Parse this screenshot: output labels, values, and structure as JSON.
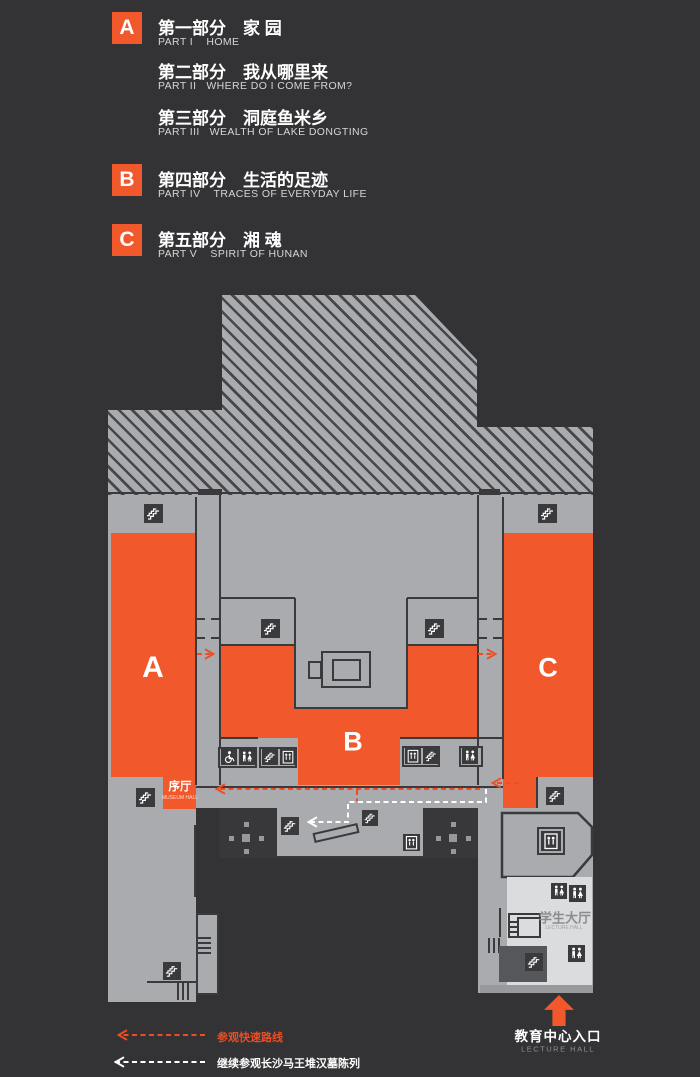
{
  "colors": {
    "orange": "#F1582B",
    "route_red": "#EE4D22",
    "background": "#333234",
    "floor_gray": "#A9ABAE",
    "wall_dark": "#3A393B",
    "light_hall": "#DBDCDD",
    "white": "#FFFFFF"
  },
  "legend": {
    "items": [
      {
        "letter": "A",
        "title": "第一部分　家 园",
        "subtitle": "PART I    HOME"
      },
      {
        "letter": "",
        "title": "第二部分　我从哪里来",
        "subtitle": "PART II   WHERE DO I COME FROM?"
      },
      {
        "letter": "",
        "title": "第三部分　洞庭鱼米乡",
        "subtitle": "PART III   WEALTH OF LAKE DONGTING"
      },
      {
        "letter": "B",
        "title": "第四部分　生活的足迹",
        "subtitle": "PART IV    TRACES OF EVERYDAY LIFE"
      },
      {
        "letter": "C",
        "title": "第五部分　湘 魂",
        "subtitle": "PART V    SPIRIT OF HUNAN"
      }
    ]
  },
  "map": {
    "zones": {
      "a": "A",
      "b": "B",
      "c": "C"
    },
    "museum_hall": {
      "zh": "序厅",
      "en": "MUSEUM HALL"
    },
    "student_hall": {
      "zh": "学生大厅",
      "en": "LECTURE HALL"
    },
    "entrance": {
      "zh": "教育中心入口",
      "en": "LECTURE HALL"
    },
    "icons": [
      {
        "type": "escalator",
        "x": 144,
        "y": 504,
        "s": 19
      },
      {
        "type": "escalator",
        "x": 538,
        "y": 504,
        "s": 19
      },
      {
        "type": "escalator",
        "x": 261,
        "y": 619,
        "s": 19
      },
      {
        "type": "escalator",
        "x": 425,
        "y": 619,
        "s": 19
      },
      {
        "type": "wheelchair",
        "x": 221,
        "y": 749,
        "s": 16
      },
      {
        "type": "restroom",
        "x": 239,
        "y": 749,
        "s": 16
      },
      {
        "type": "escalator",
        "x": 262,
        "y": 749,
        "s": 16
      },
      {
        "type": "elevator",
        "x": 280,
        "y": 749,
        "s": 16
      },
      {
        "type": "elevator",
        "x": 405,
        "y": 748,
        "s": 16
      },
      {
        "type": "escalator",
        "x": 423,
        "y": 748,
        "s": 16
      },
      {
        "type": "restroom",
        "x": 462,
        "y": 748,
        "s": 16
      },
      {
        "type": "escalator",
        "x": 136,
        "y": 788,
        "s": 19
      },
      {
        "type": "escalator",
        "x": 546,
        "y": 787,
        "s": 18
      },
      {
        "type": "escalator",
        "x": 281,
        "y": 817,
        "s": 18
      },
      {
        "type": "escalator",
        "x": 362,
        "y": 810,
        "s": 16
      },
      {
        "type": "elevator",
        "x": 403,
        "y": 834,
        "s": 17
      },
      {
        "type": "elevator",
        "x": 541,
        "y": 831,
        "s": 20,
        "boxed": true
      },
      {
        "type": "restroom",
        "x": 551,
        "y": 883,
        "s": 16
      },
      {
        "type": "restroom",
        "x": 569,
        "y": 885,
        "s": 17
      },
      {
        "type": "restroom",
        "x": 568,
        "y": 945,
        "s": 17
      },
      {
        "type": "escalator",
        "x": 163,
        "y": 962,
        "s": 18
      },
      {
        "type": "escalator",
        "x": 525,
        "y": 953,
        "s": 18
      }
    ]
  },
  "route_legend": {
    "quick": "参观快速路线",
    "continue": "继续参观长沙马王堆汉墓陈列"
  }
}
